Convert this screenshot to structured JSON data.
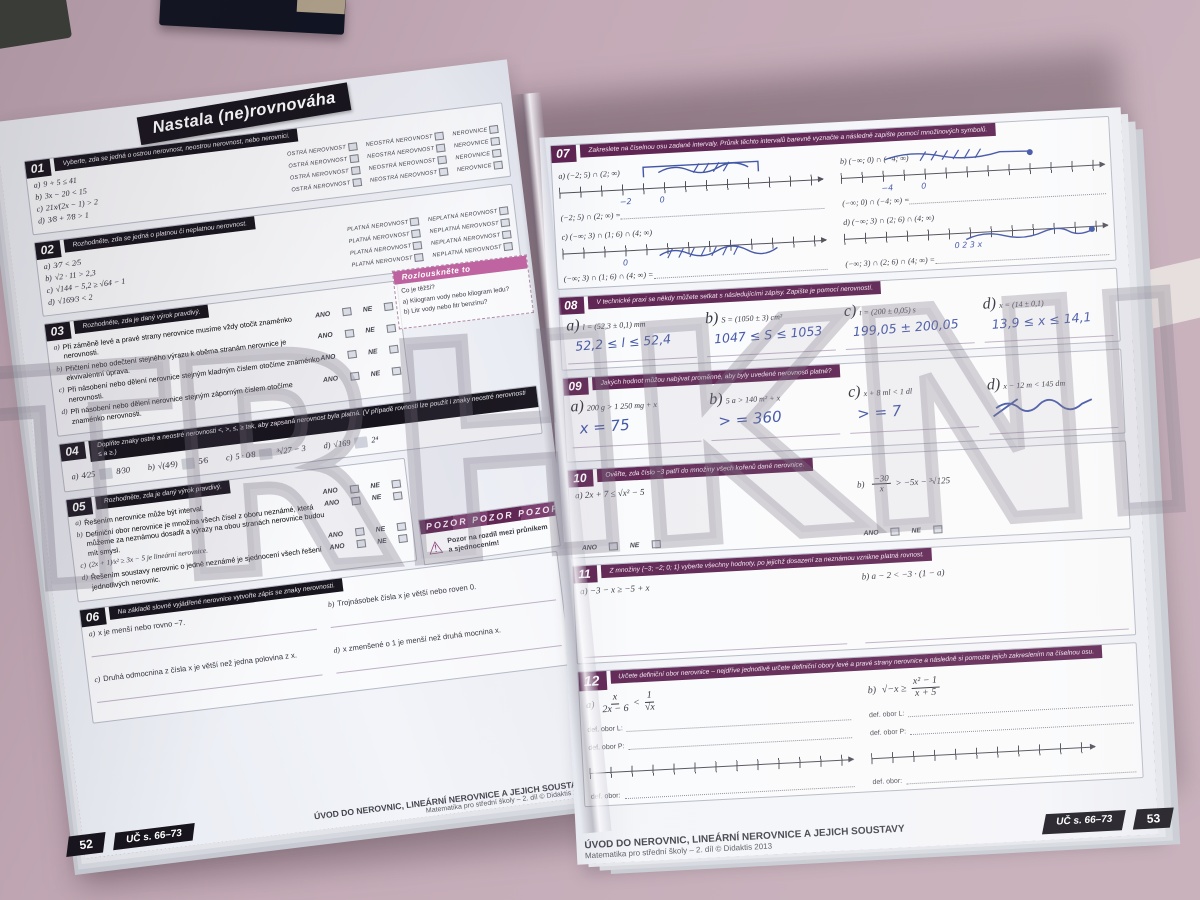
{
  "scene": {
    "watermark": "TRHKNIH"
  },
  "left_page": {
    "title": "Nastala (ne)rovnováha",
    "s01": {
      "num": "01",
      "header": "Vyberte, zda se jedná o ostrou nerovnost, neostrou nerovnost, nebo nerovnici.",
      "c1": "OSTRÁ NEROVNOST",
      "c2": "NEOSTRÁ NEROVNOST",
      "c3": "NEROVNICE",
      "items": [
        {
          "k": "a)",
          "m": "9 + 5 ≤ 41"
        },
        {
          "k": "b)",
          "m": "3x − 20 < 15"
        },
        {
          "k": "c)",
          "m": "21x⁄(2x − 1) > 2"
        },
        {
          "k": "d)",
          "m": "3⁄8 + 7⁄8 > 1"
        }
      ]
    },
    "s02": {
      "num": "02",
      "header": "Rozhodněte, zda se jedná o platnou či neplatnou nerovnost.",
      "c1": "PLATNÁ NEROVNOST",
      "c2": "NEPLATNÁ NEROVNOST",
      "items": [
        {
          "k": "a)",
          "m": "3⁄7 < 2⁄5"
        },
        {
          "k": "b)",
          "m": "√2 · 11 > 2,3"
        },
        {
          "k": "c)",
          "m": "√144 − 5,2 ≥ √64 − 1"
        },
        {
          "k": "d)",
          "m": "√169⁄3 < 2"
        }
      ]
    },
    "puzzle": {
      "title": "Rozlouskněte to",
      "q": "Co je těžší?",
      "a": "a)  Kilogram vody nebo kilogram ledu?",
      "b": "b)  Litr vody nebo litr benzínu?"
    },
    "s03": {
      "num": "03",
      "header": "Rozhodněte, zda je daný výrok pravdivý.",
      "ano": "ANO",
      "ne": "NE",
      "items": [
        {
          "k": "a)",
          "t": "Při záměně levé a pravé strany nerovnice musíme vždy otočit znaménko nerovnosti."
        },
        {
          "k": "b)",
          "t": "Přičtení nebo odečtení stejného výrazu k oběma stranám nerovnice je ekvivalentní úprava."
        },
        {
          "k": "c)",
          "t": "Při násobení nebo dělení nerovnice stejným kladným číslem otočíme znaménko nerovnosti."
        },
        {
          "k": "d)",
          "t": "Při násobení nebo dělení nerovnice stejným záporným číslem otočíme znaménko nerovnosti."
        }
      ]
    },
    "s04": {
      "num": "04",
      "header": "Doplňte znaky ostré a neostré nerovnosti <, >, ≤, ≥ tak, aby zapsaná nerovnost byla platná. (V případě rovnosti lze použít i znaky neostré nerovnosti ≤ a ≥.)",
      "items": [
        {
          "k": "a)",
          "l": "4⁄25",
          "r": "8⁄30"
        },
        {
          "k": "b)",
          "l": "√(4⁄9)",
          "r": "5⁄6"
        },
        {
          "k": "c)",
          "l": "5 · 0⁄8",
          "r": "³√27 − 3"
        },
        {
          "k": "d)",
          "l": "√169",
          "r": "2⁴"
        }
      ]
    },
    "warning": {
      "banner": "POZOR  POZOR  POZOR",
      "icon": "⚠",
      "text": "Pozor na rozdíl mezi průnikem a sjednocením!"
    },
    "s05": {
      "num": "05",
      "header": "Rozhodněte, zda je daný výrok pravdivý.",
      "ano": "ANO",
      "ne": "NE",
      "items": [
        {
          "k": "a)",
          "t": "Řešením nerovnice může být interval."
        },
        {
          "k": "b)",
          "t": "Definiční obor nerovnice je množina všech čísel z oboru neznámé, která můžeme za neznámou dosadit a výrazy na obou stranách nerovnice budou mít smysl."
        },
        {
          "k": "c)",
          "t": "(2x + 1)⁄x² ≥ 3x − 5 je lineární nerovnice."
        },
        {
          "k": "d)",
          "t": "Řešením soustavy nerovnic o jedné neznámé je sjednocení všech řešení jednotlivých nerovnic."
        }
      ]
    },
    "s06": {
      "num": "06",
      "header": "Na základě slovně vyjádřené nerovnice vytvořte zápis se znaky nerovnosti.",
      "items": [
        {
          "k": "a)",
          "t": "x je menší nebo rovno −7."
        },
        {
          "k": "b)",
          "t": "Trojnásobek čísla x je větší nebo roven 0."
        },
        {
          "k": "c)",
          "t": "Druhá odmocnina z čísla x je větší než jedna polovina z x."
        },
        {
          "k": "d)",
          "t": "x zmenšené o 1 je menší než druhá mocnina x."
        }
      ]
    },
    "footer": {
      "page": "52",
      "tab": "UČ s. 66–73",
      "title": "ÚVOD DO NEROVNIC, LINEÁRNÍ NEROVNICE A JEJICH SOUSTAVY",
      "sub": "Matematika pro střední školy – 2. díl © Didaktis 2013"
    }
  },
  "right_page": {
    "s07": {
      "num": "07",
      "header": "Zakreslete na číselnou osu zadané intervaly. Průnik těchto intervalů barevně vyznačte a následně zapište pomocí množinových symbolů.",
      "a": "a)  (−2; 5) ∩ (2; ∞)",
      "b": "b)  (−∞; 0) ∩ (−4; ∞)",
      "a_eq": "(−2; 5) ∩ (2; ∞) =",
      "b_eq": "(−∞; 0) ∩ (−4; ∞) =",
      "c": "c)  (−∞; 3) ∩ (1; 6) ∩ (4; ∞)",
      "d": "d)  (−∞; 3) ∩ (2; 6) ∩ (4; ∞)",
      "c_eq": "(−∞; 3) ∩ (1; 6) ∩ (4; ∞) =",
      "d_eq": "(−∞; 3) ∩ (2; 6) ∩ (4; ∞) =",
      "hw_a1": "−2",
      "hw_a2": "0",
      "hw_b1": "−4",
      "hw_b2": "0",
      "hw_c1": "0",
      "hw_d": "0    2    3    x"
    },
    "s08": {
      "num": "08",
      "header": "V technické praxi se někdy můžete setkat s následujícími zápisy. Zapište je pomocí nerovností.",
      "items": [
        {
          "k": "a)",
          "m": "l = (52,3 ± 0,1) mm",
          "hw": "52,2 ≤ l ≤ 52,4"
        },
        {
          "k": "b)",
          "m": "S = (1050 ± 3) cm²",
          "hw": "1047 ≤ S ≤ 1053"
        },
        {
          "k": "c)",
          "m": "t = (200 ± 0,05) s",
          "hw": "199,05 ± 200,05"
        },
        {
          "k": "d)",
          "m": "x = (14 ± 0,1)",
          "hw": "13,9 ≤ x ≤ 14,1"
        }
      ]
    },
    "s09": {
      "num": "09",
      "header": "Jakých hodnot můžou nabývat proměnné, aby byly uvedené nerovnosti platné?",
      "items": [
        {
          "k": "a)",
          "m": "200 g > 1 250 mg + x",
          "hw": "x = 75"
        },
        {
          "k": "b)",
          "m": "5 a > 140 m² + x",
          "hw": "> = 360"
        },
        {
          "k": "c)",
          "m": "x + 8 ml < 1 dl",
          "hw": "> = 7"
        },
        {
          "k": "d)",
          "m": "x − 12 m < 145 dm",
          "hw": ""
        }
      ]
    },
    "s10": {
      "num": "10",
      "header": "Ověřte, zda číslo −3 patří do množiny všech kořenů dané nerovnice.",
      "ano": "ANO",
      "ne": "NE",
      "a": "a)  2x + 7 ≤ √x² − 5",
      "b_k": "b)",
      "b_num": "−30",
      "b_den": "x",
      "b_rest": "> −5x − ³√125"
    },
    "s11": {
      "num": "11",
      "header": "Z množiny {−3; −2; 0; 1} vyberte všechny hodnoty, po jejichž dosazení za neznámou vznikne platná rovnost.",
      "a": "a)  −3 − x ≥ −5 + x",
      "b": "b)  a − 2 < −3 · (1 − a)"
    },
    "s12": {
      "num": "12",
      "header": "Určete definiční obor nerovnice – nejdříve jednotlivě určete definiční obory levé a pravé strany nerovnice a následně si pomozte jejich zakreslením na číselnou osu.",
      "a_k": "a)",
      "a_f1n": "x",
      "a_f1d": "2x − 6",
      "a_mid": "<",
      "a_f2n": "1",
      "a_f2d": "√x",
      "b_k": "b)",
      "b_pre": "√−x  ≥",
      "b_fn": "x² − 1",
      "b_fd": "x + 5",
      "def_l": "def. obor L:",
      "def_p": "def. obor P:",
      "def": "def. obor:"
    },
    "footer": {
      "title": "ÚVOD DO NEROVNIC, LINEÁRNÍ NEROVNICE A JEJICH SOUSTAVY",
      "sub": "Matematika pro střední školy – 2. díl © Didaktis 2013",
      "tab": "UČ s. 66–73",
      "page": "53"
    }
  }
}
